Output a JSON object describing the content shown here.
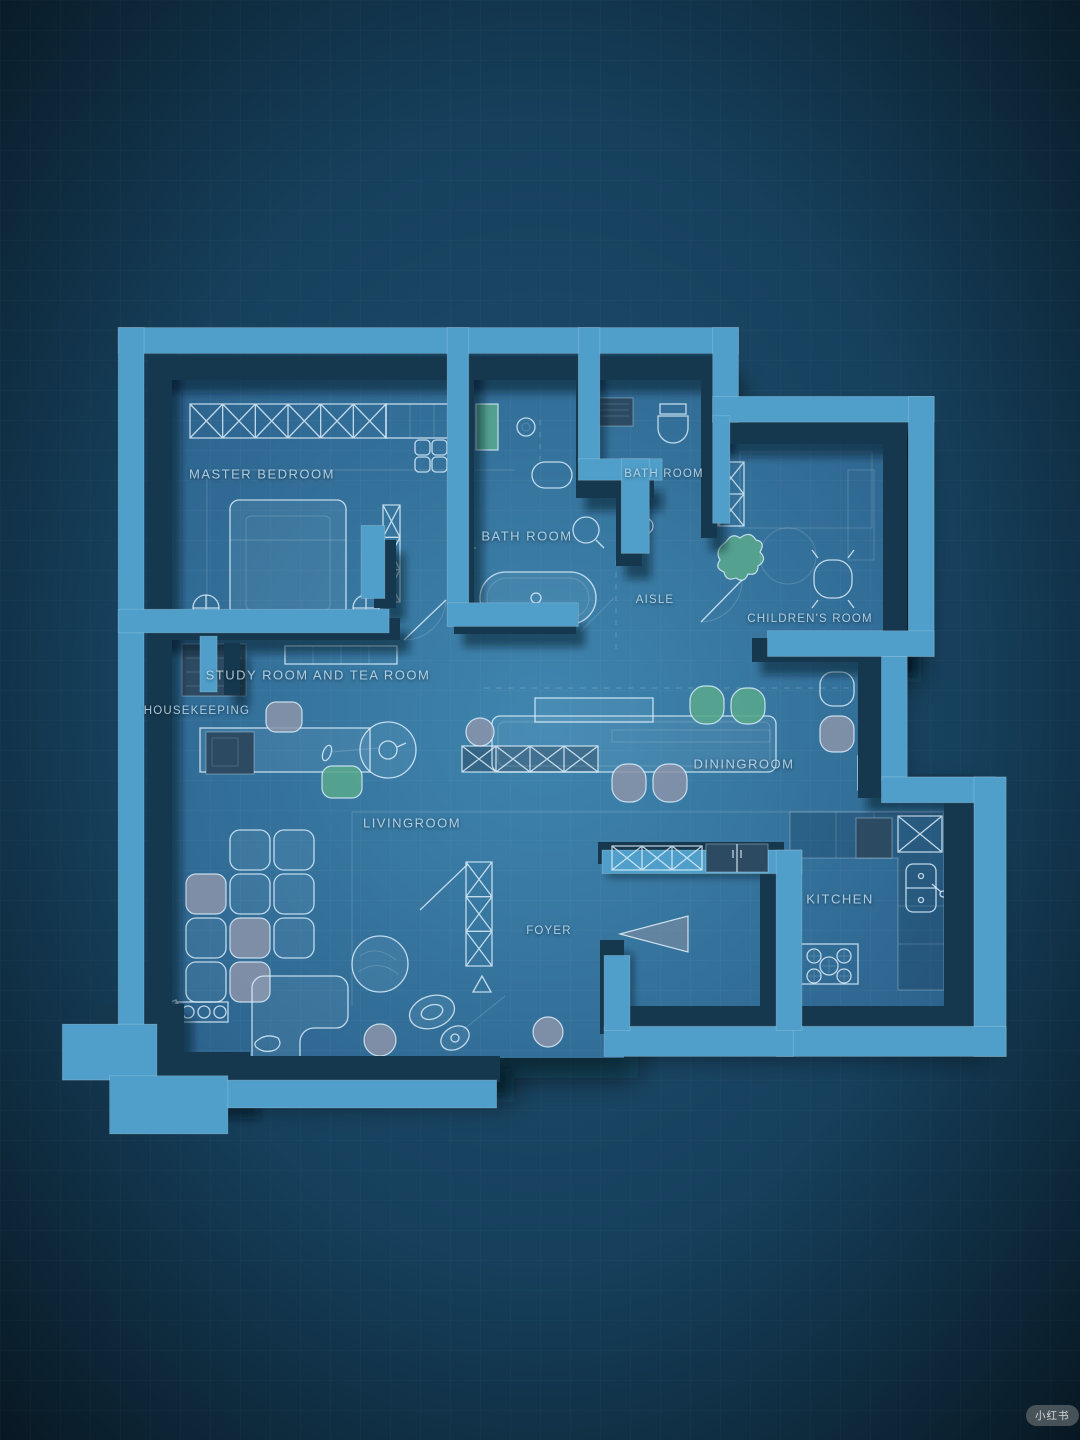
{
  "meta": {
    "watermark": "小红书",
    "type": "3d-blueprint-floorplan"
  },
  "palette": {
    "bg_hi": "#215273",
    "bg_mid": "#16405c",
    "bg_lo": "#081823",
    "floor_hi": "#3f86af",
    "floor_lo": "#2b618b",
    "wall_top": "#4f9fca",
    "wall_side": "#16384e",
    "line": "rgba(224,242,254,0.82)",
    "green": "#58a78c",
    "gray": "#8b94a9",
    "slate": "#2c4a61",
    "label": "rgba(206,232,247,0.8)",
    "grid": "rgba(140,200,230,0.06)",
    "floor_grid": "rgba(255,255,255,0.055)"
  },
  "rooms": {
    "master_bedroom": {
      "label": "MASTER BEDROOM"
    },
    "bath_main": {
      "label": "BATH ROOM"
    },
    "bath_second": {
      "label": "BATH ROOM"
    },
    "aisle": {
      "label": "AISLE"
    },
    "childrens_room": {
      "label": "CHILDREN'S ROOM"
    },
    "study_tea": {
      "label": "STUDY ROOM AND TEA ROOM"
    },
    "housekeeping": {
      "label": "HOUSEKEEPING"
    },
    "dining": {
      "label": "DININGROOM"
    },
    "living": {
      "label": "LIVINGROOM"
    },
    "kitchen": {
      "label": "KITCHEN"
    },
    "foyer": {
      "label": "FOYER"
    }
  }
}
